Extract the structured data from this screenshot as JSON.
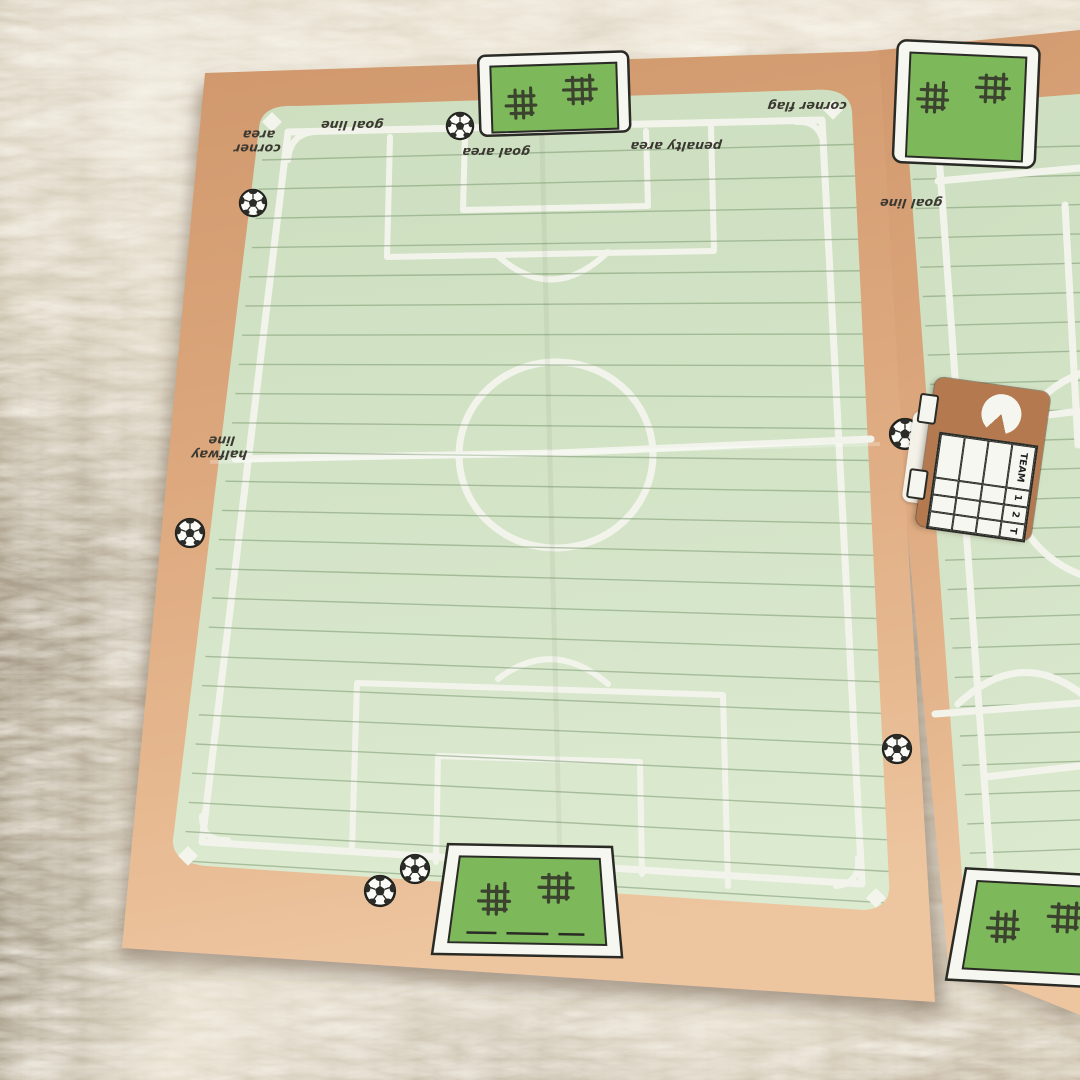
{
  "scene": {
    "description": "Two kraft-paper soccer pitch memo sheets lying on a white shag carpet",
    "sheet_count": 2
  },
  "pitch": {
    "labels": {
      "corner_area": "corner area",
      "goal_line": "goal line",
      "goal_area": "goal area",
      "penalty_area": "penalty area",
      "corner_flag": "corner flag",
      "halfway_line": "halfway line"
    }
  },
  "sheet2": {
    "labels": {
      "goal_line": "goal line"
    }
  },
  "scoreboard": {
    "headers": [
      "TEAM",
      "1",
      "2",
      "T"
    ],
    "empty_rows": 3
  },
  "icons": {
    "soccer_ball": "soccer-ball",
    "goal_net": "goal-net",
    "clock": "clock"
  },
  "colors": {
    "kraft": "#d49a6f",
    "kraft_light": "#ecc49e",
    "field": "#cddfc0",
    "field_light": "#dcead0",
    "line": "#f2f4ec",
    "ruled": "#7d9a72",
    "goal_green": "#7db85a",
    "ink": "#2b2b26",
    "label_ink": "#3a3831",
    "board_brown": "#b5794f",
    "carpet": "#eae3d4",
    "carpet_shadow": "#b9ab94"
  }
}
